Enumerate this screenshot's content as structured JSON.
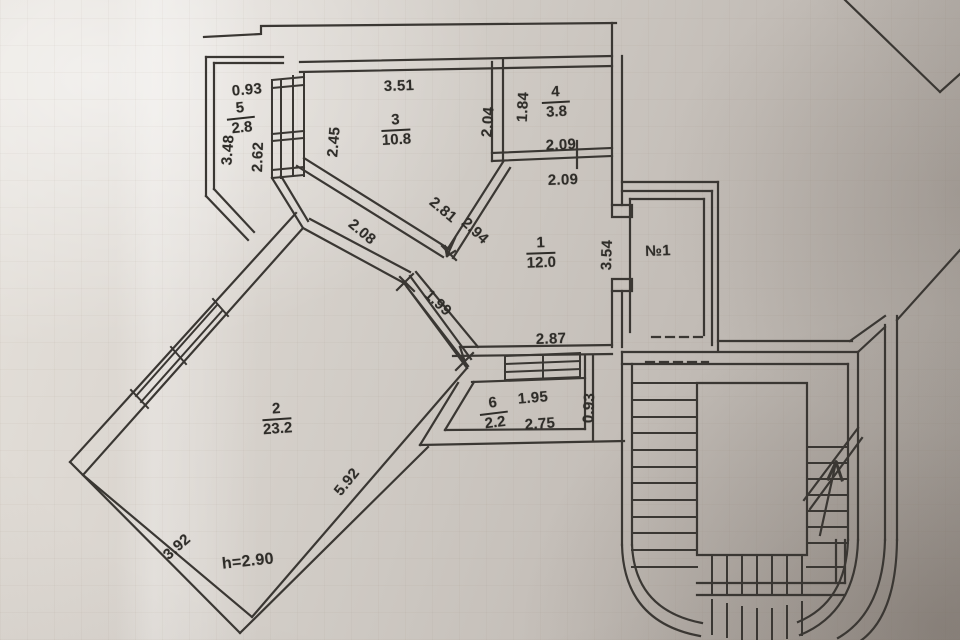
{
  "plan": {
    "rooms": [
      {
        "number": "1",
        "area": "12.0"
      },
      {
        "number": "2",
        "area": "23.2"
      },
      {
        "number": "3",
        "area": "10.8"
      },
      {
        "number": "4",
        "area": "3.8"
      },
      {
        "number": "5",
        "area": "2.8"
      },
      {
        "number": "6",
        "area": "2.2"
      }
    ],
    "dims": {
      "balcony5_width": "0.93",
      "balcony5_side": "3.48",
      "wall_262": "2.62",
      "room3_left": "2.45",
      "room3_top": "3.51",
      "room3_right": "2.04",
      "room4_left": "1.84",
      "room4_width": "2.09",
      "room4_door": "2.09",
      "hall_upper": "2.08",
      "hall_281": "2.81",
      "hall_294": "2.94",
      "window_199": "1.99",
      "room1_right": "3.54",
      "room1_bottom": "2.87",
      "balcony6_top": "1.95",
      "balcony6_bottom": "2.75",
      "balcony6_depth": "0.93",
      "room2_southeast": "5.92",
      "room2_southwest": "3.92"
    },
    "notes": {
      "ceiling_height": "h=2.90",
      "unit_number": "№1"
    },
    "colors": {
      "ink": "#3a3733",
      "paper_light": "#e6e2dc",
      "paper_dark": "#a49e98"
    }
  }
}
